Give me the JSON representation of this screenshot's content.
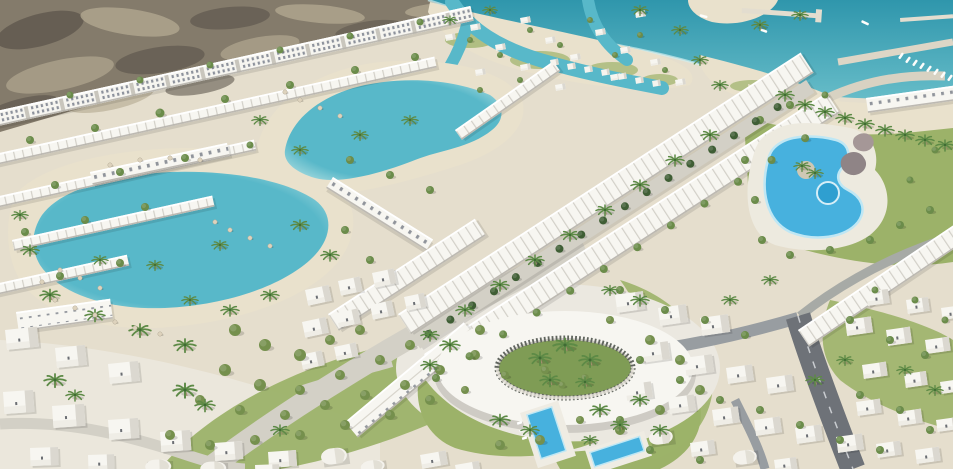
{
  "image": {
    "type": "architectural-aerial-render",
    "description": "Aerial 3D render of a white coastal resort masterplan: rocky desert hills behind diagonal rows of white apartments and townhouses, turquoise swimmable lagoons with sandy beaches and umbrellas, winding sea channels with overwater cabins, a marina with piers and boats on a teal sea, a palm-tree-lined central street between dense white row houses, a free-form lagoon pool with rock features, a white ring-shaped building around a palm courtyard, scattered white villas with gardens, rectangular blue pools and an asphalt road",
    "palette": {
      "sand": "#e5decd",
      "beach": "#e9e1cc",
      "desert": "#847b6b",
      "desertDark": "#5f584e",
      "desertLight": "#b2a890",
      "sea": "#2f96ac",
      "seaLight": "#66bcc8",
      "lagoon": "#58b8c9",
      "lagoonEdge": "#a9dcdf",
      "pool": "#47b1de",
      "poolDeep": "#2f9fd0",
      "white": "#f7f6f1",
      "shade": "#dbd8d0",
      "plaza": "#ebe8e0",
      "lawn": "#9cb269",
      "lawnDark": "#7f9c55",
      "treeGreen": "#6b8c4a",
      "treeOlive": "#75904d",
      "treeDark": "#3f5e35",
      "palmGreen": "#5d8a46",
      "roadLight": "#d3d0c6",
      "roadDark": "#6e7278",
      "rock": "#8f8486"
    },
    "elements": [
      "desert-hills",
      "apartment-row",
      "townhouse-rows",
      "beach-clubs",
      "swim-lagoon-upper",
      "swim-lagoon-main",
      "sea",
      "marina",
      "piers",
      "water-channels",
      "overwater-cabins",
      "sand-islands",
      "central-tree-lined-street",
      "lagoon-pool",
      "rock-feature",
      "ring-building",
      "courtyard-palms",
      "garden-villas",
      "rectangular-pools",
      "asphalt-road",
      "light-avenue",
      "beach-umbrellas",
      "palm-trees",
      "lawns"
    ]
  }
}
